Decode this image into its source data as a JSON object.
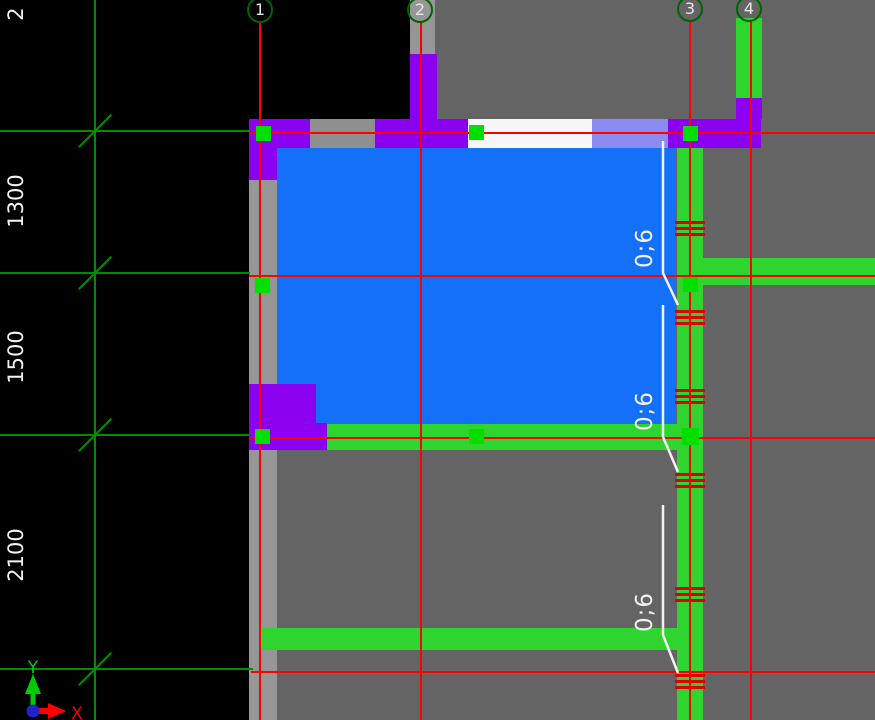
{
  "colors": {
    "background_black": "#000000",
    "background_gray": "#646464",
    "strip_gray": "#969696",
    "wall_gray": "#8F8F8F",
    "slab_blue": "#1470F8",
    "wall_purple": "#8C00F0",
    "wall_lavender": "#8C8CF0",
    "wall_white": "#F7F7F7",
    "beam_green": "#2FD42F",
    "node_green": "#00DF00",
    "grid_red": "#FF0000",
    "hatch_red": "#DC0000",
    "grid_green": "#008C00",
    "bubble_green": "#006400",
    "annotation_white": "#F2F2F2",
    "axis_x_red": "#FF0000",
    "axis_y_green": "#00CC00",
    "axis_origin_blue": "#2222CC"
  },
  "grid": {
    "bubbles": [
      {
        "label": "1"
      },
      {
        "label": "2"
      },
      {
        "label": "3"
      },
      {
        "label": "4"
      }
    ]
  },
  "dimensions": {
    "top_partial": "2",
    "d1": "1300",
    "d2": "1500",
    "d3": "2100"
  },
  "rebar": {
    "labels": [
      "0;6",
      "0;6",
      "0;6"
    ]
  },
  "axis": {
    "x": "X",
    "y": "Y"
  }
}
